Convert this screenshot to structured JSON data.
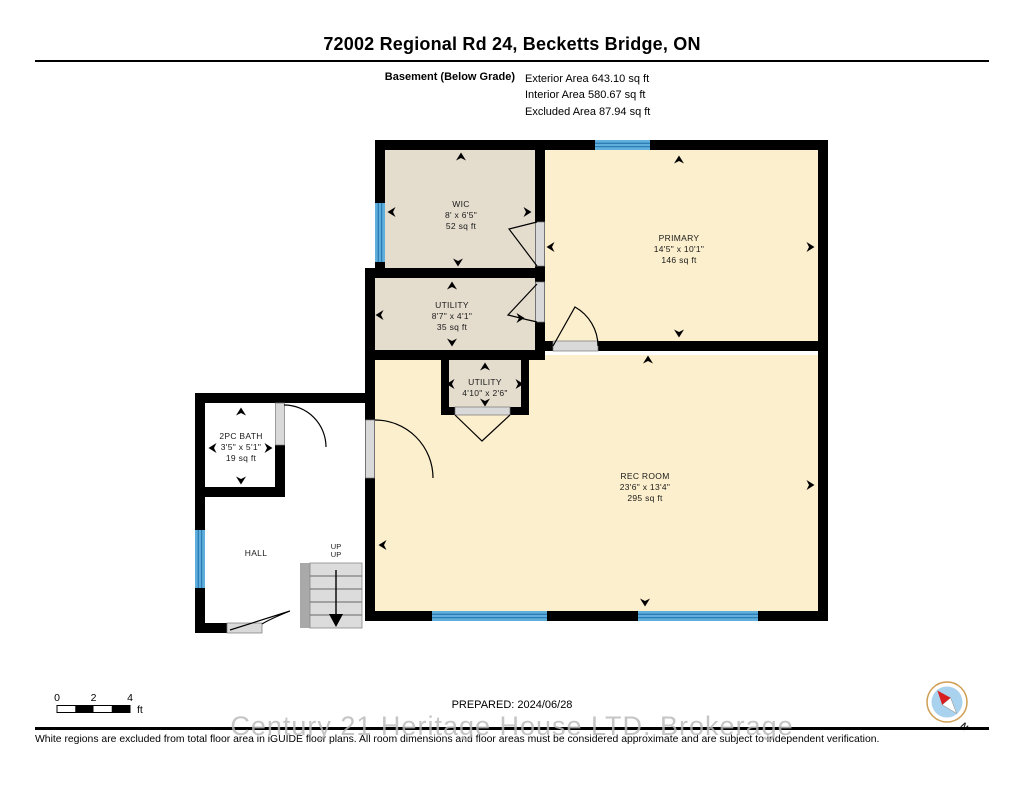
{
  "header": {
    "title": "72002 Regional Rd 24, Becketts Bridge, ON",
    "floor_label": "Basement (Below Grade)",
    "areas": {
      "exterior": "Exterior Area 643.10 sq ft",
      "interior": "Interior Area 580.67 sq ft",
      "excluded": "Excluded Area 87.94 sq ft"
    }
  },
  "plan": {
    "rooms": [
      {
        "name": "WIC",
        "dims": "8' x 6'5\"",
        "area": "52 sq ft"
      },
      {
        "name": "PRIMARY",
        "dims": "14'5\" x 10'1\"",
        "area": "146 sq ft"
      },
      {
        "name": "UTILITY",
        "dims": "8'7\" x 4'1\"",
        "area": "35 sq ft"
      },
      {
        "name": "UTILITY",
        "dims": "4'10\" x 2'6\""
      },
      {
        "name": "2PC BATH",
        "dims": "3'5\" x 5'1\"",
        "area": "19 sq ft"
      },
      {
        "name": "HALL"
      },
      {
        "name": "REC ROOM",
        "dims": "23'6\" x 13'4\"",
        "area": "295 sq ft"
      }
    ],
    "stairs": {
      "label_1": "UP",
      "label_2": "UP"
    },
    "colors": {
      "wall": "#000000",
      "room_yellow": "#fcefcd",
      "room_beige": "#e4dccd",
      "excluded_white": "#ffffff",
      "window_blue": "#5FAEDC",
      "window_stripe": "#2d7cb5",
      "door_gray": "#d9d9d9"
    }
  },
  "footer": {
    "scale": {
      "t0": "0",
      "t2": "2",
      "t4": "4",
      "unit": "ft"
    },
    "prepared": "PREPARED: 2024/06/28",
    "compass_label": "N",
    "watermark": "Century 21 Heritage House LTD. Brokerage",
    "disclaimer": "White regions are excluded from total floor area in iGUIDE floor plans. All room dimensions and floor areas must be considered approximate and are subject to independent verification."
  }
}
